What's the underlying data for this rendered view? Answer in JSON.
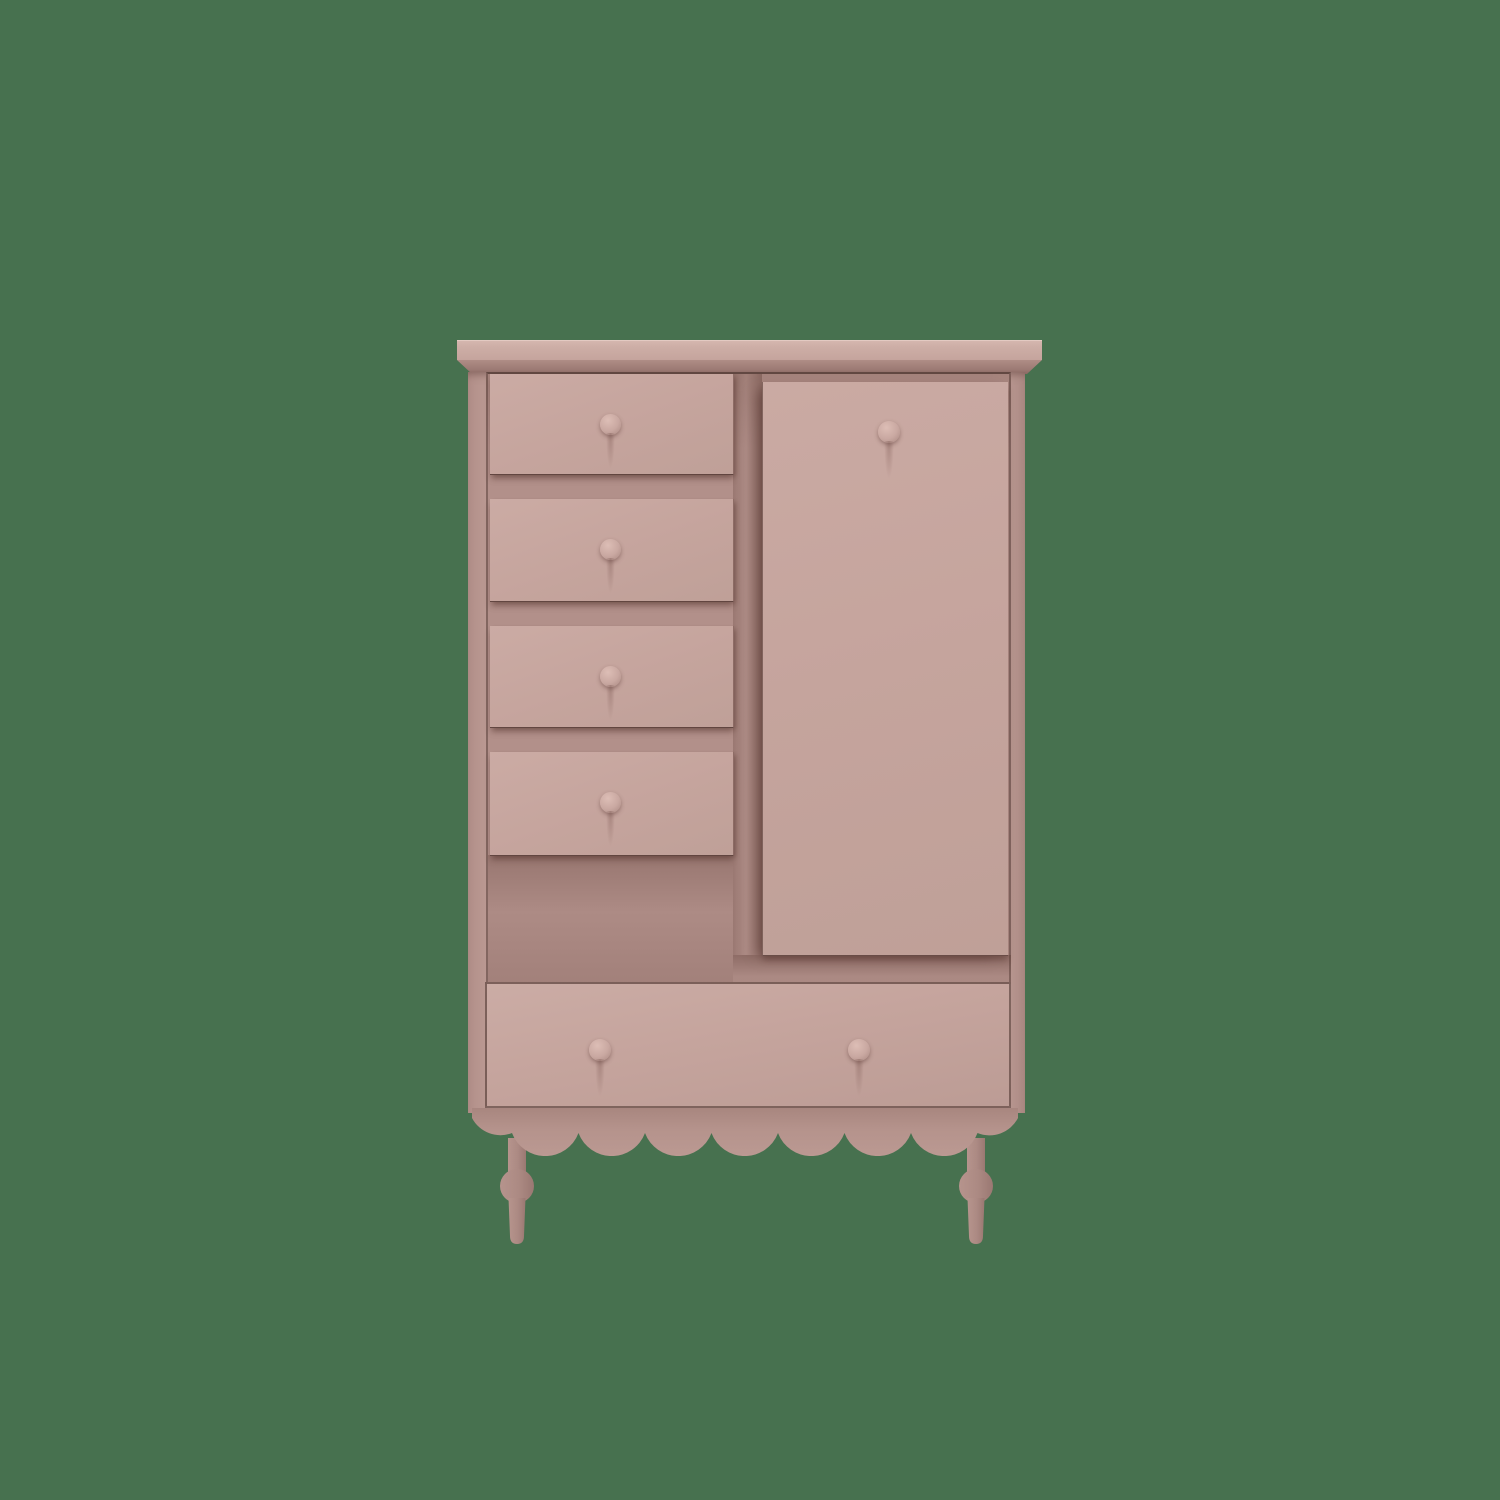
{
  "scene": {
    "type": "product-photo",
    "description": "Dusty pink wooden wardrobe cabinet on a plain green background: four small drawers stacked on the left, a tall cupboard door on the right, one wide drawer across the bottom, a scalloped apron and two turned spindle legs",
    "background_style": "solid muted green, no floor shadow",
    "small_drawer_count": 4,
    "door_count": 1,
    "wide_drawer_count": 1,
    "knob_count": 7,
    "scallop_count": 9,
    "leg_count": 2
  },
  "palette": {
    "bg": "#47714F",
    "face": "#C5A49D",
    "wood": "#BC9B94",
    "well": "#B2908A",
    "recess": "#A5837C",
    "seam": "rgba(61,39,34,0.65)",
    "cornice-light": "#D6B8B0",
    "cornice-shadow": "#9B7973",
    "knob-light": "#DDBEB6",
    "knob-mid": "#C9A8A1",
    "knob-dark": "#A98881",
    "leg-light": "#B6948D",
    "leg-dark": "#9A7872",
    "apron-light": "#BB9992",
    "apron-dark": "#A8867F"
  }
}
